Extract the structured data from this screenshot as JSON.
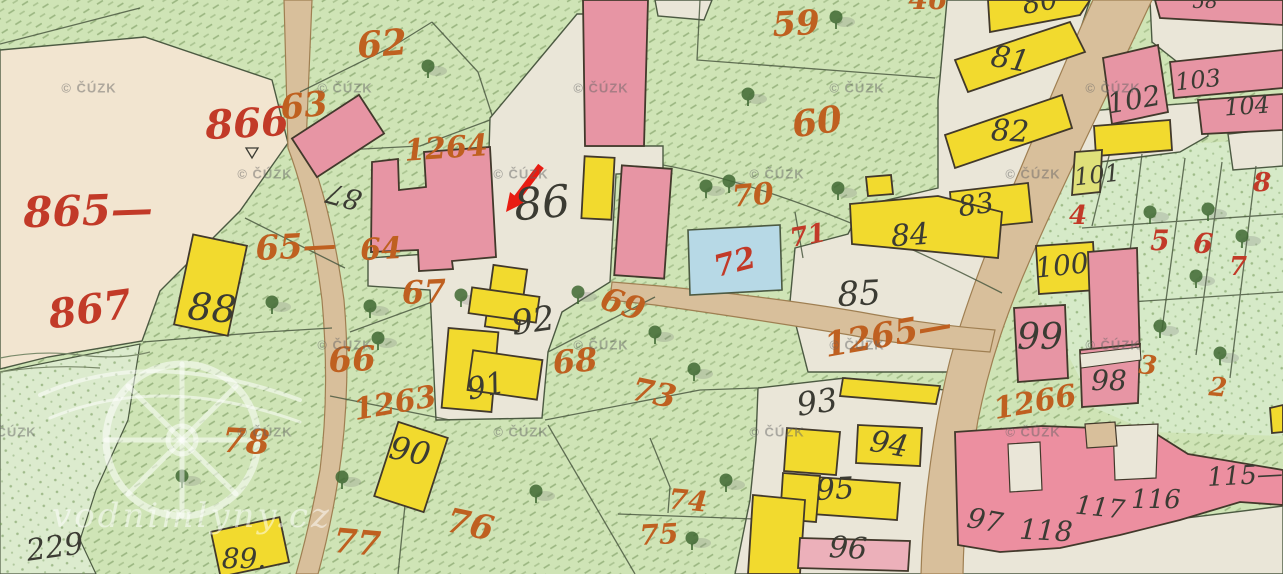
{
  "map": {
    "copyright_watermark": {
      "text": "© ČÚZK",
      "positions": [
        [
          89,
          88
        ],
        [
          345,
          88
        ],
        [
          601,
          88
        ],
        [
          857,
          88
        ],
        [
          1113,
          88
        ],
        [
          265,
          174
        ],
        [
          521,
          174
        ],
        [
          777,
          174
        ],
        [
          1033,
          174
        ],
        [
          345,
          345
        ],
        [
          601,
          345
        ],
        [
          857,
          345
        ],
        [
          1113,
          345
        ],
        [
          9,
          432
        ],
        [
          265,
          432
        ],
        [
          521,
          432
        ],
        [
          777,
          432
        ],
        [
          1033,
          432
        ]
      ]
    },
    "site_watermark": {
      "text": "vodnimlyny.cz"
    },
    "arrow": {
      "color": "#e81c12",
      "tail": [
        541,
        166
      ],
      "shaft_end": [
        517,
        198
      ],
      "head_points": "506,212 524,203 510,192"
    },
    "colors": {
      "bg": "#cfe4b6",
      "meadow": "#dcebce",
      "garden": "#d6eac8",
      "cream": "#f2e5d0",
      "court": "#eae6d8",
      "road": "#d8bf9b",
      "road_edge": "#9f7f52",
      "pink": "#e795a4",
      "pink_deep": "#ec8fa0",
      "pink_light": "#ecb0ba",
      "yellow": "#f2da2e",
      "yellow_green": "#dfe07a",
      "blue": "#b7d9e6",
      "line": "#4c5a42",
      "building_line": "#42392b",
      "ink": "#3b3b33",
      "red": "#c23a28",
      "orange": "#bf6020",
      "tree": "#3f6833",
      "arrow": "#e81c12",
      "watermark": "rgba(100,100,100,0.48)",
      "logo": "rgba(255,255,255,0.5)"
    },
    "labels": [
      {
        "t": "86",
        "x": 542,
        "y": 204,
        "s": 44,
        "r": -5,
        "c": "black"
      },
      {
        "t": "87",
        "x": 344,
        "y": 196,
        "s": 28,
        "r": 195,
        "c": "black"
      },
      {
        "t": "88",
        "x": 212,
        "y": 308,
        "s": 38,
        "r": 5,
        "c": "black"
      },
      {
        "t": "92",
        "x": 533,
        "y": 321,
        "s": 34,
        "r": -8,
        "c": "black"
      },
      {
        "t": "91",
        "x": 486,
        "y": 387,
        "s": 30,
        "r": -12,
        "c": "black"
      },
      {
        "t": "90",
        "x": 410,
        "y": 451,
        "s": 32,
        "r": 12,
        "c": "black"
      },
      {
        "t": "85",
        "x": 859,
        "y": 294,
        "s": 34,
        "r": -3,
        "c": "black"
      },
      {
        "t": "93",
        "x": 817,
        "y": 402,
        "s": 32,
        "r": -8,
        "c": "black"
      },
      {
        "t": "94",
        "x": 889,
        "y": 445,
        "s": 30,
        "r": 10,
        "c": "black"
      },
      {
        "t": "95",
        "x": 835,
        "y": 490,
        "s": 30,
        "r": -3,
        "c": "black"
      },
      {
        "t": "96",
        "x": 848,
        "y": 549,
        "s": 30,
        "r": 3,
        "c": "black"
      },
      {
        "t": "97",
        "x": 985,
        "y": 521,
        "s": 28,
        "r": 10,
        "c": "black"
      },
      {
        "t": "118",
        "x": 1046,
        "y": 531,
        "s": 28,
        "r": 3,
        "c": "black"
      },
      {
        "t": "117",
        "x": 1100,
        "y": 508,
        "s": 26,
        "r": 6,
        "c": "black"
      },
      {
        "t": "116",
        "x": 1156,
        "y": 500,
        "s": 26,
        "r": 0,
        "c": "black"
      },
      {
        "t": "115—",
        "x": 1245,
        "y": 476,
        "s": 26,
        "r": -3,
        "c": "black"
      },
      {
        "t": "98",
        "x": 1109,
        "y": 381,
        "s": 28,
        "r": 0,
        "c": "black"
      },
      {
        "t": "99",
        "x": 1040,
        "y": 338,
        "s": 36,
        "r": 0,
        "c": "black"
      },
      {
        "t": "100",
        "x": 1062,
        "y": 266,
        "s": 28,
        "r": -6,
        "c": "black"
      },
      {
        "t": "101",
        "x": 1097,
        "y": 175,
        "s": 24,
        "r": -6,
        "c": "black"
      },
      {
        "t": "102",
        "x": 1134,
        "y": 100,
        "s": 28,
        "r": -10,
        "c": "black"
      },
      {
        "t": "103",
        "x": 1198,
        "y": 80,
        "s": 24,
        "r": -6,
        "c": "black"
      },
      {
        "t": "104",
        "x": 1247,
        "y": 106,
        "s": 24,
        "r": -4,
        "c": "black"
      },
      {
        "t": "81",
        "x": 1010,
        "y": 60,
        "s": 30,
        "r": 10,
        "c": "black"
      },
      {
        "t": "82",
        "x": 1010,
        "y": 132,
        "s": 30,
        "r": 3,
        "c": "black"
      },
      {
        "t": "83",
        "x": 976,
        "y": 205,
        "s": 28,
        "r": -8,
        "c": "black"
      },
      {
        "t": "84",
        "x": 910,
        "y": 236,
        "s": 30,
        "r": -4,
        "c": "black"
      },
      {
        "t": "80",
        "x": 1040,
        "y": 2,
        "s": 28,
        "r": -10,
        "c": "black"
      },
      {
        "t": "58",
        "x": 1205,
        "y": 1,
        "s": 20,
        "r": 0,
        "c": "black"
      },
      {
        "t": "229",
        "x": 55,
        "y": 548,
        "s": 30,
        "r": -8,
        "c": "black"
      },
      {
        "t": "89.",
        "x": 244,
        "y": 559,
        "s": 28,
        "r": 0,
        "c": "black"
      },
      {
        "t": "865—",
        "x": 88,
        "y": 211,
        "s": 42,
        "r": -2,
        "c": "red"
      },
      {
        "t": "866",
        "x": 247,
        "y": 124,
        "s": 40,
        "r": -3,
        "c": "red"
      },
      {
        "t": "867",
        "x": 90,
        "y": 310,
        "s": 40,
        "r": -8,
        "c": "red"
      },
      {
        "t": "71",
        "x": 808,
        "y": 236,
        "s": 26,
        "r": -10,
        "c": "red"
      },
      {
        "t": "72",
        "x": 735,
        "y": 263,
        "s": 30,
        "r": -15,
        "c": "red"
      },
      {
        "t": "4",
        "x": 1078,
        "y": 216,
        "s": 26,
        "r": 0,
        "c": "red"
      },
      {
        "t": "5",
        "x": 1160,
        "y": 241,
        "s": 28,
        "r": 0,
        "c": "red"
      },
      {
        "t": "6",
        "x": 1203,
        "y": 244,
        "s": 28,
        "r": 5,
        "c": "red"
      },
      {
        "t": "7",
        "x": 1238,
        "y": 267,
        "s": 26,
        "r": 0,
        "c": "red"
      },
      {
        "t": "8",
        "x": 1262,
        "y": 183,
        "s": 26,
        "r": 0,
        "c": "red"
      },
      {
        "t": "1264",
        "x": 446,
        "y": 149,
        "s": 30,
        "r": -4,
        "c": "orange"
      },
      {
        "t": "1263",
        "x": 395,
        "y": 404,
        "s": 30,
        "r": -10,
        "c": "orange"
      },
      {
        "t": "1265—",
        "x": 888,
        "y": 335,
        "s": 34,
        "r": -10,
        "c": "orange"
      },
      {
        "t": "1266",
        "x": 1035,
        "y": 403,
        "s": 30,
        "r": -10,
        "c": "orange"
      },
      {
        "t": "62",
        "x": 382,
        "y": 44,
        "s": 36,
        "r": -5,
        "c": "orange"
      },
      {
        "t": "63",
        "x": 304,
        "y": 106,
        "s": 34,
        "r": -6,
        "c": "orange"
      },
      {
        "t": "59",
        "x": 796,
        "y": 24,
        "s": 34,
        "r": -3,
        "c": "orange"
      },
      {
        "t": "60",
        "x": 817,
        "y": 122,
        "s": 36,
        "r": -8,
        "c": "orange"
      },
      {
        "t": "64",
        "x": 381,
        "y": 250,
        "s": 30,
        "r": -3,
        "c": "orange"
      },
      {
        "t": "65—",
        "x": 296,
        "y": 247,
        "s": 34,
        "r": -3,
        "c": "orange"
      },
      {
        "t": "66",
        "x": 352,
        "y": 360,
        "s": 34,
        "r": -3,
        "c": "orange"
      },
      {
        "t": "67",
        "x": 424,
        "y": 292,
        "s": 32,
        "r": -3,
        "c": "orange"
      },
      {
        "t": "68",
        "x": 575,
        "y": 361,
        "s": 32,
        "r": -5,
        "c": "orange"
      },
      {
        "t": "69",
        "x": 623,
        "y": 304,
        "s": 32,
        "r": 18,
        "c": "orange"
      },
      {
        "t": "70",
        "x": 753,
        "y": 196,
        "s": 30,
        "r": -5,
        "c": "orange"
      },
      {
        "t": "73",
        "x": 654,
        "y": 393,
        "s": 32,
        "r": 12,
        "c": "orange"
      },
      {
        "t": "74",
        "x": 688,
        "y": 501,
        "s": 28,
        "r": 5,
        "c": "orange"
      },
      {
        "t": "75",
        "x": 659,
        "y": 535,
        "s": 28,
        "r": -3,
        "c": "orange"
      },
      {
        "t": "76",
        "x": 470,
        "y": 525,
        "s": 34,
        "r": 12,
        "c": "orange"
      },
      {
        "t": "77",
        "x": 357,
        "y": 543,
        "s": 34,
        "r": 5,
        "c": "orange"
      },
      {
        "t": "78",
        "x": 246,
        "y": 442,
        "s": 34,
        "r": 3,
        "c": "orange"
      },
      {
        "t": "3",
        "x": 1148,
        "y": 366,
        "s": 26,
        "r": 5,
        "c": "orange"
      },
      {
        "t": "2",
        "x": 1218,
        "y": 388,
        "s": 26,
        "r": 5,
        "c": "orange"
      },
      {
        "t": "46",
        "x": 928,
        "y": 0,
        "s": 28,
        "r": 0,
        "c": "orange"
      }
    ],
    "trees": [
      [
        428,
        66
      ],
      [
        748,
        94
      ],
      [
        706,
        186
      ],
      [
        729,
        181
      ],
      [
        838,
        188
      ],
      [
        836,
        17
      ],
      [
        272,
        302
      ],
      [
        370,
        306
      ],
      [
        378,
        338
      ],
      [
        461,
        295
      ],
      [
        578,
        292
      ],
      [
        655,
        332
      ],
      [
        694,
        369
      ],
      [
        536,
        491
      ],
      [
        182,
        476
      ],
      [
        342,
        477
      ],
      [
        726,
        480
      ],
      [
        692,
        538
      ],
      [
        1150,
        212
      ],
      [
        1208,
        209
      ],
      [
        1242,
        236
      ],
      [
        1196,
        276
      ],
      [
        1160,
        326
      ],
      [
        1220,
        353
      ]
    ]
  }
}
